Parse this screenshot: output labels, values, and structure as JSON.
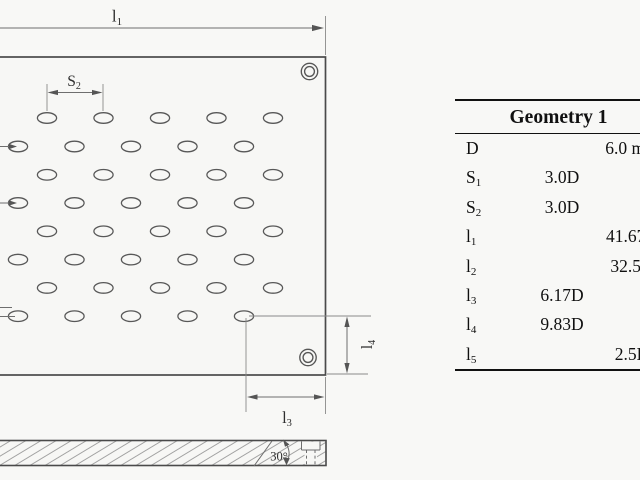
{
  "figure": {
    "drawing": {
      "labels": {
        "l1": {
          "base": "l",
          "sub": "1"
        },
        "s2": {
          "base": "S",
          "sub": "2"
        },
        "l3": {
          "base": "l",
          "sub": "3"
        },
        "l4": {
          "base": "l",
          "sub": "4"
        },
        "angle": "30°"
      }
    },
    "table": {
      "header": "Geometry 1",
      "rows": [
        {
          "param": "D",
          "sub": "",
          "rel": "",
          "abs": "6.0 mm"
        },
        {
          "param": "S",
          "sub": "1",
          "rel": "3.0D",
          "abs": ""
        },
        {
          "param": "S",
          "sub": "2",
          "rel": "3.0D",
          "abs": ""
        },
        {
          "param": "l",
          "sub": "1",
          "rel": "",
          "abs": "41.67D"
        },
        {
          "param": "l",
          "sub": "2",
          "rel": "",
          "abs": "32.5D"
        },
        {
          "param": "l",
          "sub": "3",
          "rel": "6.17D",
          "abs": ""
        },
        {
          "param": "l",
          "sub": "4",
          "rel": "9.83D",
          "abs": ""
        },
        {
          "param": "l",
          "sub": "5",
          "rel": "",
          "abs": "2.5D"
        }
      ]
    },
    "colors": {
      "ink": "#3e3e3e",
      "dim_lines": "#6e6e6e",
      "hatch": "#9c9c9c",
      "table_ink": "#101010",
      "background": "#f8f8f6"
    }
  }
}
